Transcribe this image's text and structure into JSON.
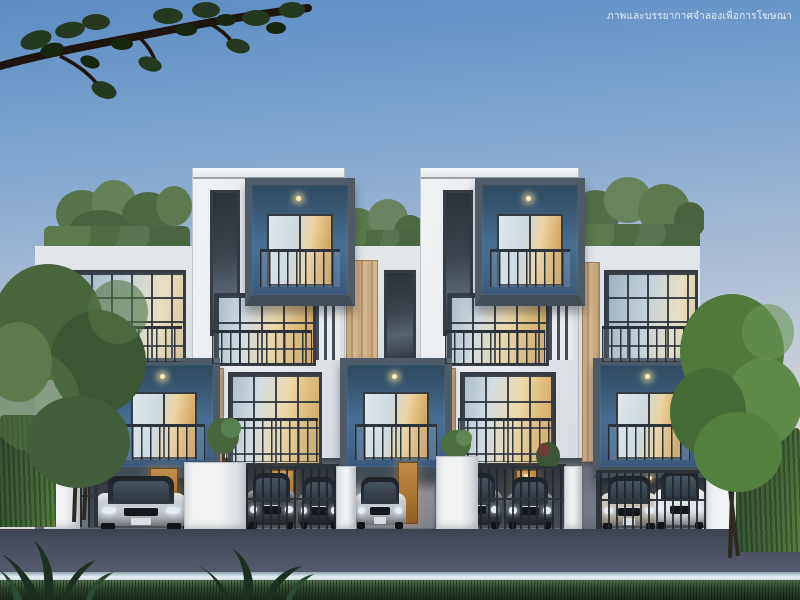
{
  "disclaimer": "ภาพและบรรยากาศจำลองเพื่อการโฆษณา",
  "scene": {
    "subject": "Modern three-storey townhome row at dusk, 3D rendering",
    "units": 5,
    "features": [
      "rooftop gardens",
      "steel-blue box balconies",
      "glass and steel railings",
      "carports with parked cars",
      "metal gates",
      "hedge fences",
      "street and grass foreground",
      "overhanging tree branch"
    ]
  },
  "palette": {
    "sky_top": "#5d8cc3",
    "sky_horizon": "#ddd9d4",
    "wall_white": "#eceef1",
    "wall_light": "#d9dee3",
    "parapet_dark": "#596068",
    "balcony_blue": "#41658a",
    "balcony_frame": "#4e5a66",
    "wood_panel": "#c0a279",
    "window_warm_light": "#dcba79",
    "window_cool_glass": "#c6d2da",
    "ground_grey": "#767c85",
    "carport_dark": "#3a4046",
    "door_wood": "#a9742f",
    "road": "#4b5060",
    "curb": "#e9f0f5",
    "grass": "#2c4030",
    "hedge": "#416337",
    "foliage": "#4e713f",
    "branch": "#20170f",
    "lamp_warm": "#ffeebb"
  },
  "cars": [
    {
      "name": "silver sedan",
      "color": "#c6cbd1"
    },
    {
      "name": "dark grey sedan",
      "color": "#363b42"
    },
    {
      "name": "dark grey suv",
      "color": "#3a4046"
    },
    {
      "name": "dark grey sedan",
      "color": "#30353c"
    },
    {
      "name": "silver sedan",
      "color": "#bfc5ca"
    },
    {
      "name": "dark grey suv",
      "color": "#383e45"
    },
    {
      "name": "dark grey sedan",
      "color": "#343a41"
    },
    {
      "name": "champagne sedan",
      "color": "#c7bfae"
    },
    {
      "name": "white suv",
      "color": "#e3e6e9"
    }
  ]
}
